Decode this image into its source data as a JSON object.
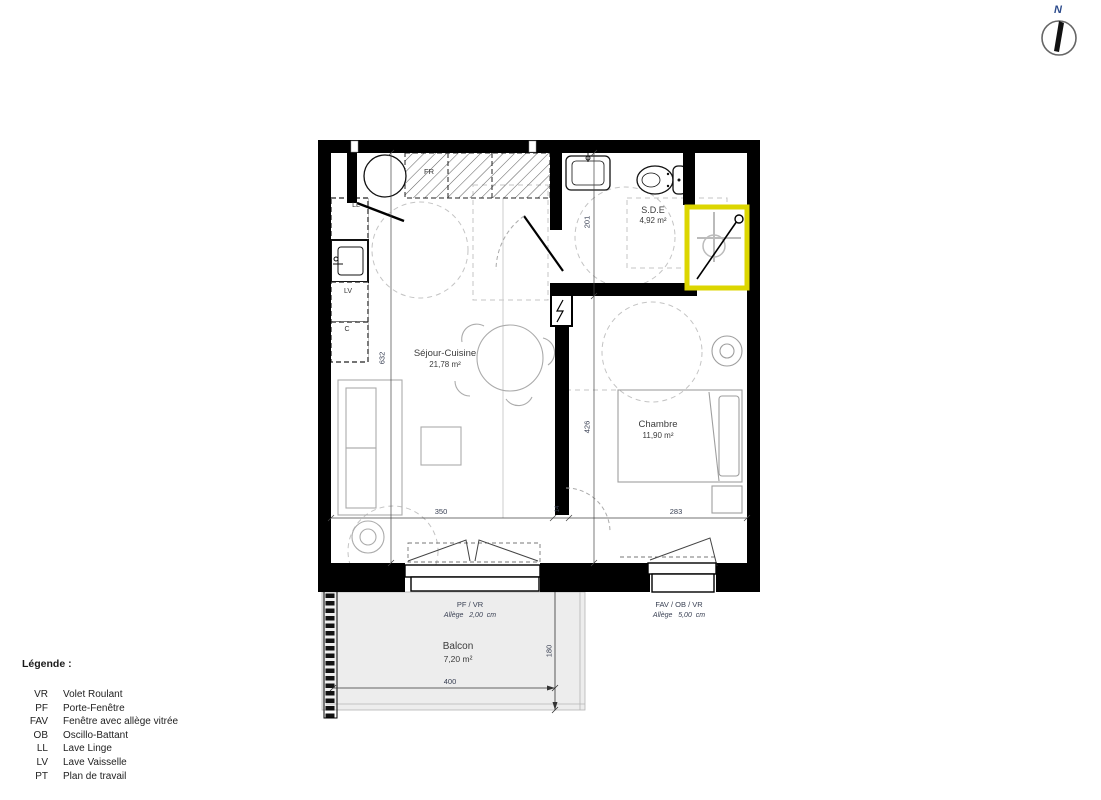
{
  "north": {
    "label": "N"
  },
  "colors": {
    "wall": "#000000",
    "shower_highlight": "#dcd600",
    "balcony_fill": "#ededed",
    "north_label": "#2b4a8b",
    "dimension_text": "#3a4154"
  },
  "rooms": {
    "sejour": {
      "name": "Séjour-Cuisine",
      "area": "21,78 m²"
    },
    "sde": {
      "name": "S.D.E",
      "area": "4,92 m²"
    },
    "chambre": {
      "name": "Chambre",
      "area": "11,90 m²"
    },
    "balcon": {
      "name": "Balcon",
      "area": "7,20 m²"
    }
  },
  "appliances": {
    "washer": "LL",
    "dishwasher": "LV",
    "cupboard": "C",
    "fridge": "FR"
  },
  "openings": {
    "sejour_window": {
      "type": "PF / VR",
      "allege": "Allège   2,00  cm"
    },
    "chambre_window": {
      "type": "FAV / OB / VR",
      "allege": "Allège   5,00  cm"
    }
  },
  "dimensions": {
    "sejour_height": "632",
    "sde_height": "201",
    "chambre_height": "426",
    "sejour_width": "350",
    "wall": "14",
    "chambre_width": "283",
    "balcon_width": "400",
    "balcon_depth": "180"
  },
  "legend": {
    "title": "Légende :",
    "items": [
      {
        "abbr": "VR",
        "label": "Volet Roulant"
      },
      {
        "abbr": "PF",
        "label": "Porte-Fenêtre"
      },
      {
        "abbr": "FAV",
        "label": "Fenêtre avec allège vitrée"
      },
      {
        "abbr": "OB",
        "label": "Oscillo-Battant"
      },
      {
        "abbr": "LL",
        "label": "Lave Linge"
      },
      {
        "abbr": "LV",
        "label": "Lave Vaisselle"
      },
      {
        "abbr": "PT",
        "label": "Plan de travail"
      }
    ]
  }
}
